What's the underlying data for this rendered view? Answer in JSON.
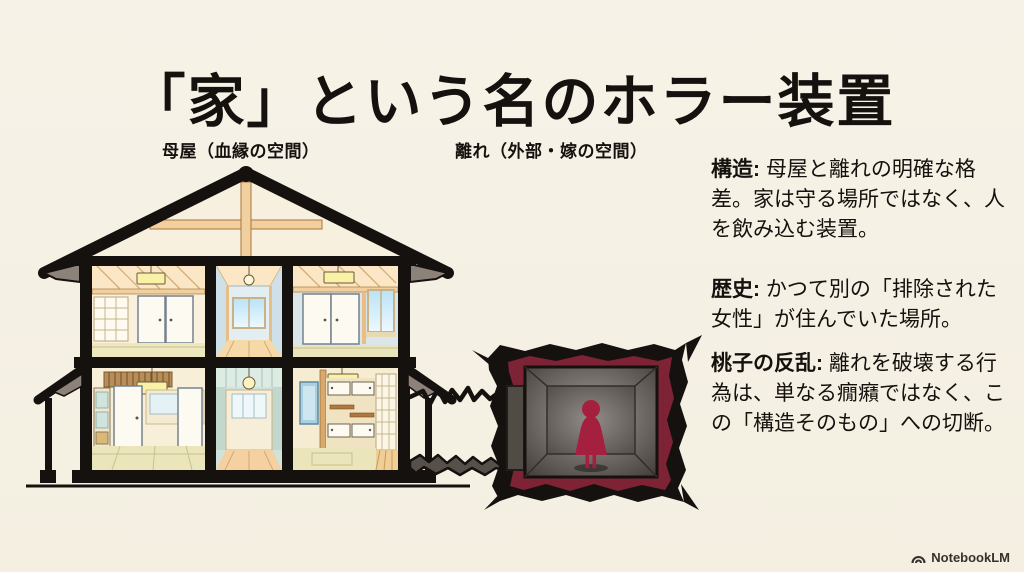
{
  "title": "「家」という名のホラー装置",
  "labels": {
    "main_house": "母屋（血縁の空間）",
    "detached_room": "離れ（外部・嫁の空間）"
  },
  "notes": [
    {
      "lead": "構造:",
      "body": " 母屋と離れの明確な格差。家は守る場所ではなく、人を飲み込む装置。"
    },
    {
      "lead": "歴史:",
      "body": " かつて別の「排除された女性」が住んでいた場所。"
    },
    {
      "lead": "桃子の反乱:",
      "body": " 離れを破壊する行為は、単なる癇癪ではなく、この「構造そのもの」への切断。"
    }
  ],
  "footer": {
    "brand": "NotebookLM"
  },
  "colors": {
    "background": "#f5f1e4",
    "ink": "#15110e",
    "frame_red": "#7e2335",
    "silhouette_red": "#a5203f",
    "wood": "#f2cf9e",
    "tatami": "#eae5bb"
  }
}
